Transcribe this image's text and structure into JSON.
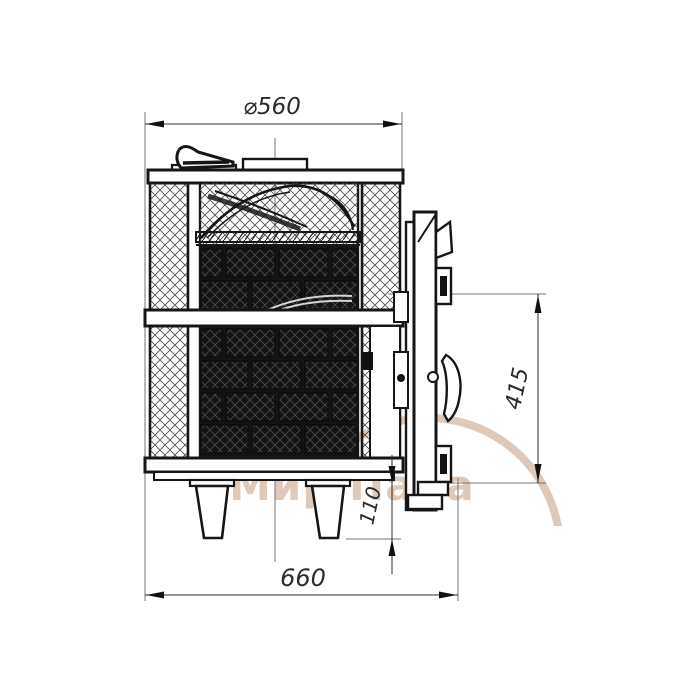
{
  "drawing": {
    "type": "technical-drawing-front-view-stove",
    "watermark": {
      "text": "Мир Пара",
      "color": "#c59d7f"
    },
    "dimensions": {
      "top_diameter": "⌀560",
      "overall_width": "660",
      "door_height": "415",
      "leg_height": "110"
    },
    "colors": {
      "background": "#ffffff",
      "main_line": "#161616",
      "thin_line": "#757575",
      "hatch": "#4a4a4a"
    }
  }
}
